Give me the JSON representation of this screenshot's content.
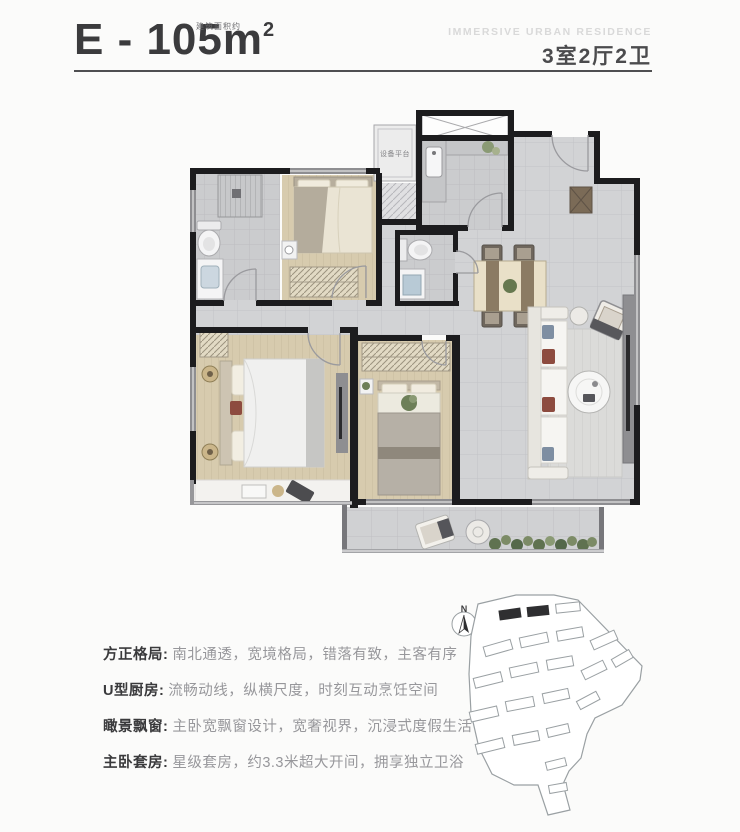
{
  "header": {
    "title_main": "E - 105m",
    "title_sup": "2",
    "title_area_note": "建筑面积约",
    "subtitle_en": "IMMERSIVE URBAN RESIDENCE",
    "room_config": "3室2厅2卫"
  },
  "plan": {
    "equipment_platform_label": "设备平台"
  },
  "features": [
    {
      "label": "方正格局:",
      "text": "南北通透，宽境格局，错落有致，主客有序"
    },
    {
      "label": "U型厨房:",
      "text": "流畅动线，纵横尺度，时刻互动烹饪空间"
    },
    {
      "label": "瞰景飘窗:",
      "text": "主卧宽飘窗设计，宽奢视界，沉浸式度假生活"
    },
    {
      "label": "主卧套房:",
      "text": "星级套房，约3.3米超大开间，拥享独立卫浴"
    }
  ],
  "site_plan": {
    "north_label": "N"
  },
  "colors": {
    "wall": "#1c1c1e",
    "window_wall": "#8e8e91",
    "tile_floor": "#d2d3d5",
    "wood_floor": "#d7cbae",
    "highlight_building": "#2f2f31",
    "text_dark": "#3b3b3d",
    "text_muted": "#97979b",
    "plant_green": "#6d7f58"
  }
}
